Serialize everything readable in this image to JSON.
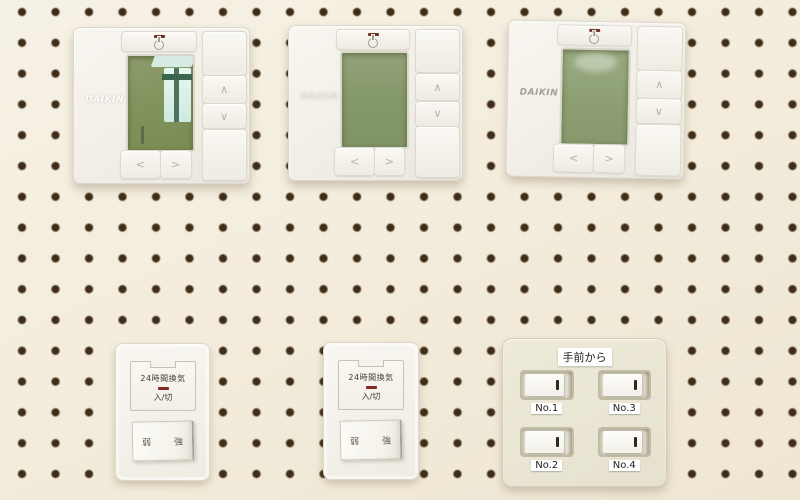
{
  "scene": {
    "description": "Pegboard display wall with three Daikin remote controllers, two 24-hour ventilation switch plates, and a four-gang numbered switch panel",
    "pegboard_color": "#f3ecdc",
    "hole_color": "#3f2d18",
    "lcd_color": "#81925c",
    "led_color": "#6e3226",
    "vent_led_color": "#7e2c1c"
  },
  "thermostats": [
    {
      "brand": "DAIKIN",
      "up": "∧",
      "down": "∨",
      "left": "<",
      "right": ">"
    },
    {
      "brand": "DAIKIN",
      "up": "∧",
      "down": "∨",
      "left": "<",
      "right": ">"
    },
    {
      "brand": "DAIKIN",
      "up": "∧",
      "down": "∨",
      "left": "<",
      "right": ">"
    }
  ],
  "vent_switches": [
    {
      "title": "24時間換気",
      "mode_label": "入/切",
      "low": "弱",
      "high": "強"
    },
    {
      "title": "24時間換気",
      "mode_label": "入/切",
      "low": "弱",
      "high": "強"
    }
  ],
  "switch_panel": {
    "header": "手前から",
    "switches": [
      {
        "label": "No.1"
      },
      {
        "label": "No.3"
      },
      {
        "label": "No.2"
      },
      {
        "label": "No.4"
      }
    ]
  }
}
